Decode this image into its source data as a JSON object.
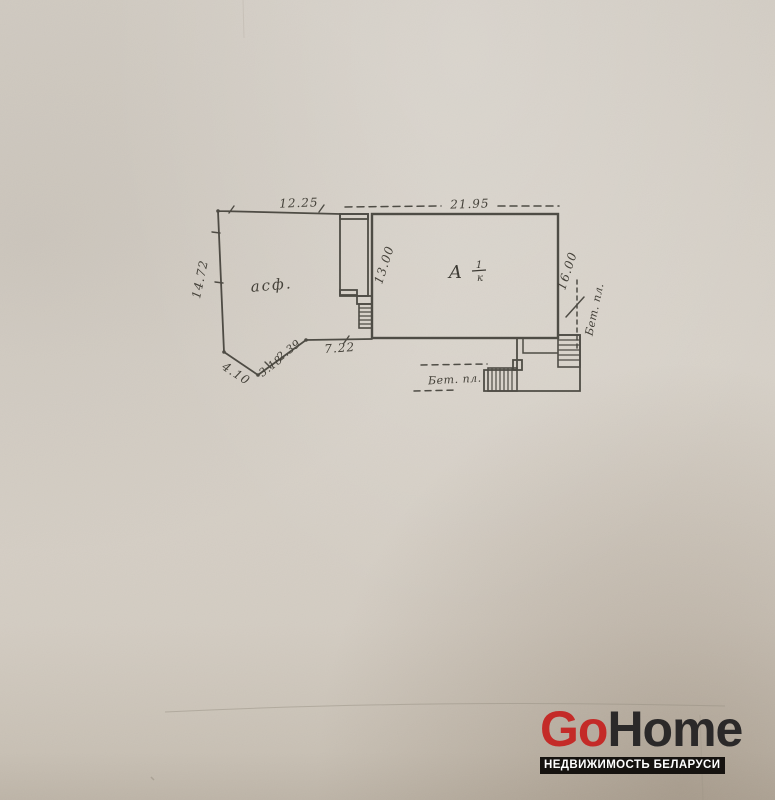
{
  "paper": {
    "base_color": "#d3cdc4",
    "ink_color": "#43413a"
  },
  "plan": {
    "yard_label": "асф.",
    "building": {
      "letter": "А",
      "fraction_numerator": "1",
      "fraction_denominator": "к"
    },
    "dims": {
      "top_left": "12.25",
      "top_main": "21.95",
      "left_side": "14.72",
      "inner_wall": "13.00",
      "right_side": "16.00",
      "slope_down": "4.10",
      "slope_up_a": "3.18",
      "slope_up_b": "2.39",
      "bottom_run": "7.22"
    },
    "pads": {
      "right_label": "Бет. пл.",
      "bottom_label": "Бет. пл."
    }
  },
  "watermark": {
    "brand_go": "Go",
    "brand_home": "Home",
    "tagline": "НЕДВИЖИМОСТЬ БЕЛАРУСИ",
    "brand_red": "#c42b28",
    "brand_dark": "#2b2929",
    "bar_bg": "#161310",
    "tagline_color": "#ffffff"
  }
}
